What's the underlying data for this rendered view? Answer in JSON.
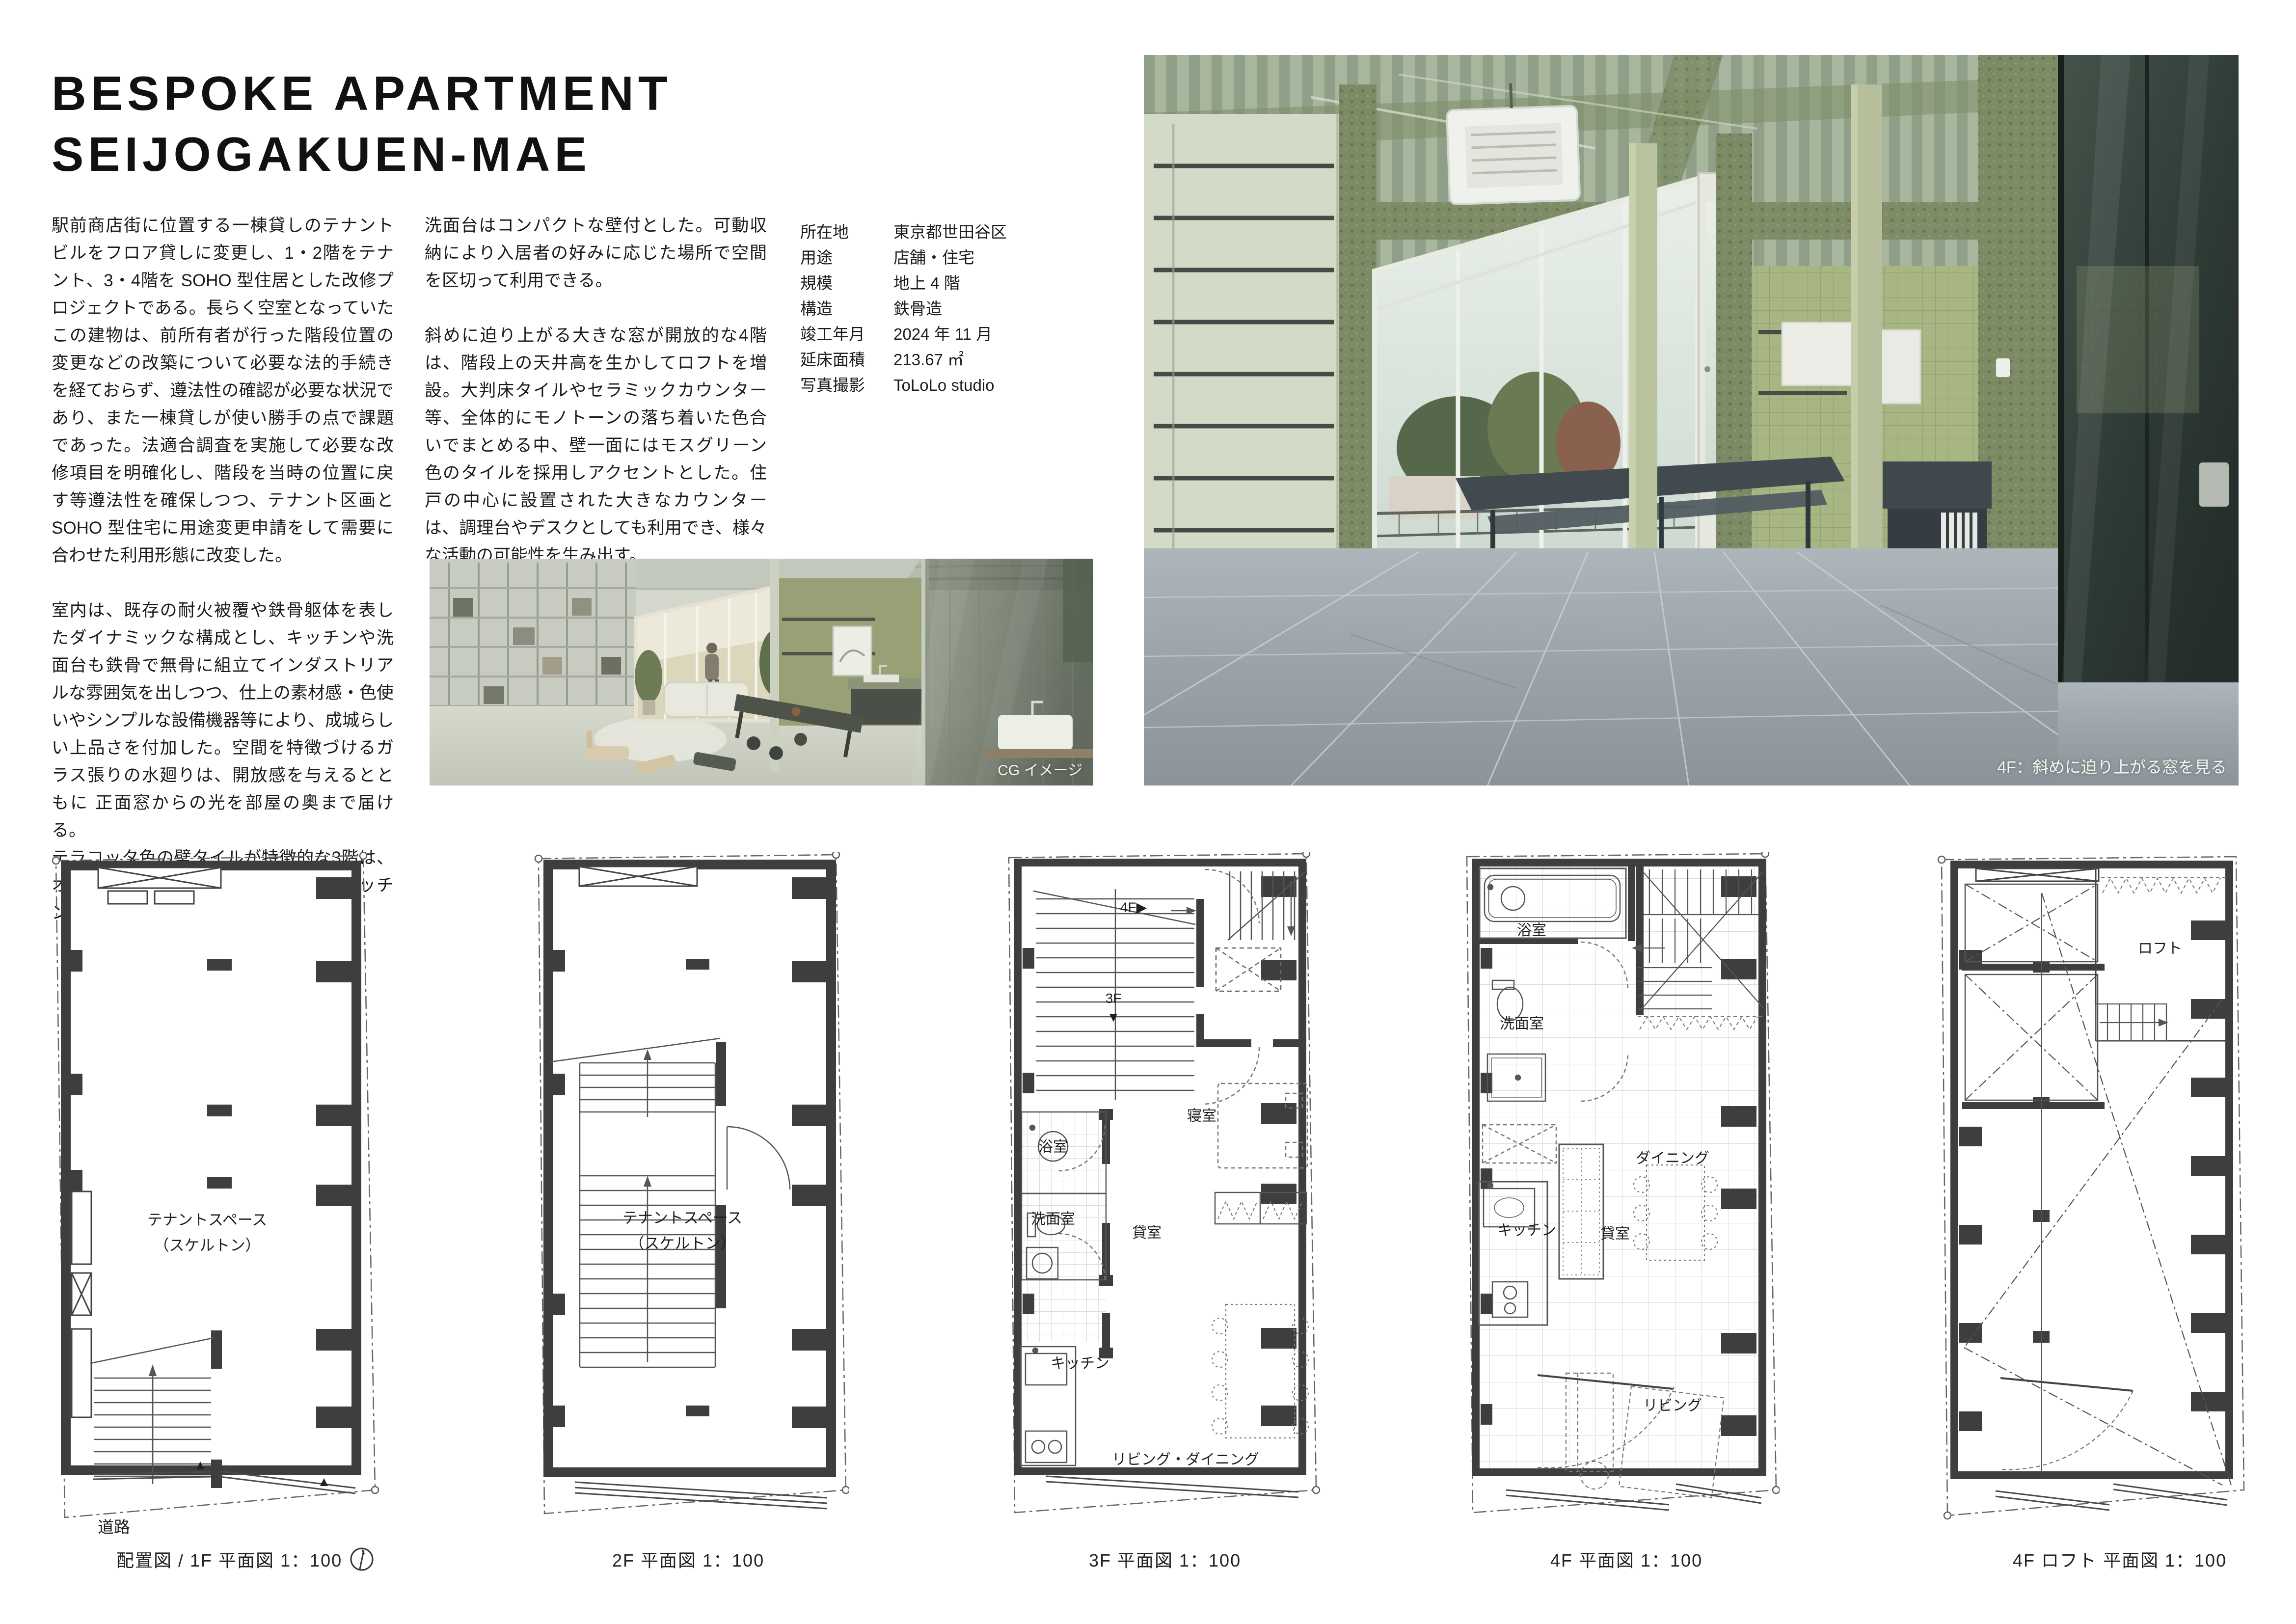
{
  "title": {
    "line1": "BESPOKE APARTMENT",
    "line2": "SEIJOGAKUEN-MAE"
  },
  "body": {
    "col1_p1": "駅前商店街に位置する一棟貸しのテナントビルをフロア貸しに変更し、1・2階をテナント、3・4階を SOHO 型住居とした改修プロジェクトである。長らく空室となっていたこの建物は、前所有者が行った階段位置の変更などの改築について必要な法的手続きを経ておらず、遵法性の確認が必要な状況であり、また一棟貸しが使い勝手の点で課題であった。法適合調査を実施して必要な改修項目を明確化し、階段を当時の位置に戻す等遵法性を確保しつつ、テナント区画と SOHO 型住宅に用途変更申請をして需要に合わせた利用形態に改変した。",
    "col1_p2": "室内は、既存の耐火被覆や鉄骨躯体を表したダイナミックな構成とし、キッチンや洗面台も鉄骨で無骨に組立てインダストリアルな雰囲気を出しつつ、仕上の素材感・色使いやシンプルな設備機器等により、成城らしい上品さを付加した。空間を特徴づけるガラス張りの水廻りは、開放感を与えるとともに 正面窓からの光を部屋の奥まで届ける。",
    "col1_p3": "テラコッタ色の壁タイルが特徴的な3階は、オープンな空間を確保できる よう、キッチンや",
    "col2_p1": "洗面台はコンパクトな壁付とした。可動収納により入居者の好みに応じた場所で空間を区切って利用できる。",
    "col2_p2": "斜めに迫り上がる大きな窓が開放的な4階は、階段上の天井高を生かしてロフトを増設。大判床タイルやセラミックカウンター等、全体的にモノトーンの落ち着いた色合いでまとめる中、壁一面にはモスグリーン色のタイルを採用しアクセントとした。住戸の中心に設置された大きなカウンターは、調理台やデスクとしても利用でき、様々な活動の可能性を生み出す。"
  },
  "info": {
    "rows": [
      {
        "label": "所在地",
        "value": "東京都世田谷区"
      },
      {
        "label": "用途",
        "value": "店舗・住宅"
      },
      {
        "label": "規模",
        "value": "地上 4 階"
      },
      {
        "label": "構造",
        "value": "鉄骨造"
      },
      {
        "label": "竣工年月",
        "value": "2024 年 11 月"
      },
      {
        "label": "延床面積",
        "value": "213.67 ㎡"
      },
      {
        "label": "写真撮影",
        "value": "ToLoLo studio"
      }
    ]
  },
  "images": {
    "cg_caption": "CG イメージ",
    "photo_caption": "4F：斜めに迫り上がる窓を見る"
  },
  "plans": [
    {
      "caption": "配置図 / 1F 平面図  1：100",
      "labels": {
        "space1": "テナントスペース",
        "space2": "（スケルトン）",
        "road": "道路"
      }
    },
    {
      "caption": "2F 平面図  1：100",
      "labels": {
        "space1": "テナントスペース",
        "space2": "（スケルトン）"
      }
    },
    {
      "caption": "3F 平面図  1：100",
      "labels": {
        "up": "4F▶",
        "down": "3F",
        "downarrow": "▼",
        "bedroom": "寝室",
        "bath": "浴室",
        "wash": "洗面室",
        "rental": "貸室",
        "kitchen": "キッチン",
        "ld": "リビング・ダイニング"
      }
    },
    {
      "caption": "4F 平面図  1：100",
      "labels": {
        "bath": "浴室",
        "wash": "洗面室",
        "kitchen": "キッチン",
        "rental": "貸室",
        "dining": "ダイニング",
        "living": "リビング"
      }
    },
    {
      "caption": "4F ロフト 平面図  1：100",
      "labels": {
        "loft": "ロフト"
      }
    }
  ],
  "colors": {
    "moss_green": "#7c8b65",
    "tile_green": "#a8b683",
    "floor_gray": "#9aa4aa",
    "wall_ink": "#3d3f3e",
    "text": "#1a1a1a"
  }
}
